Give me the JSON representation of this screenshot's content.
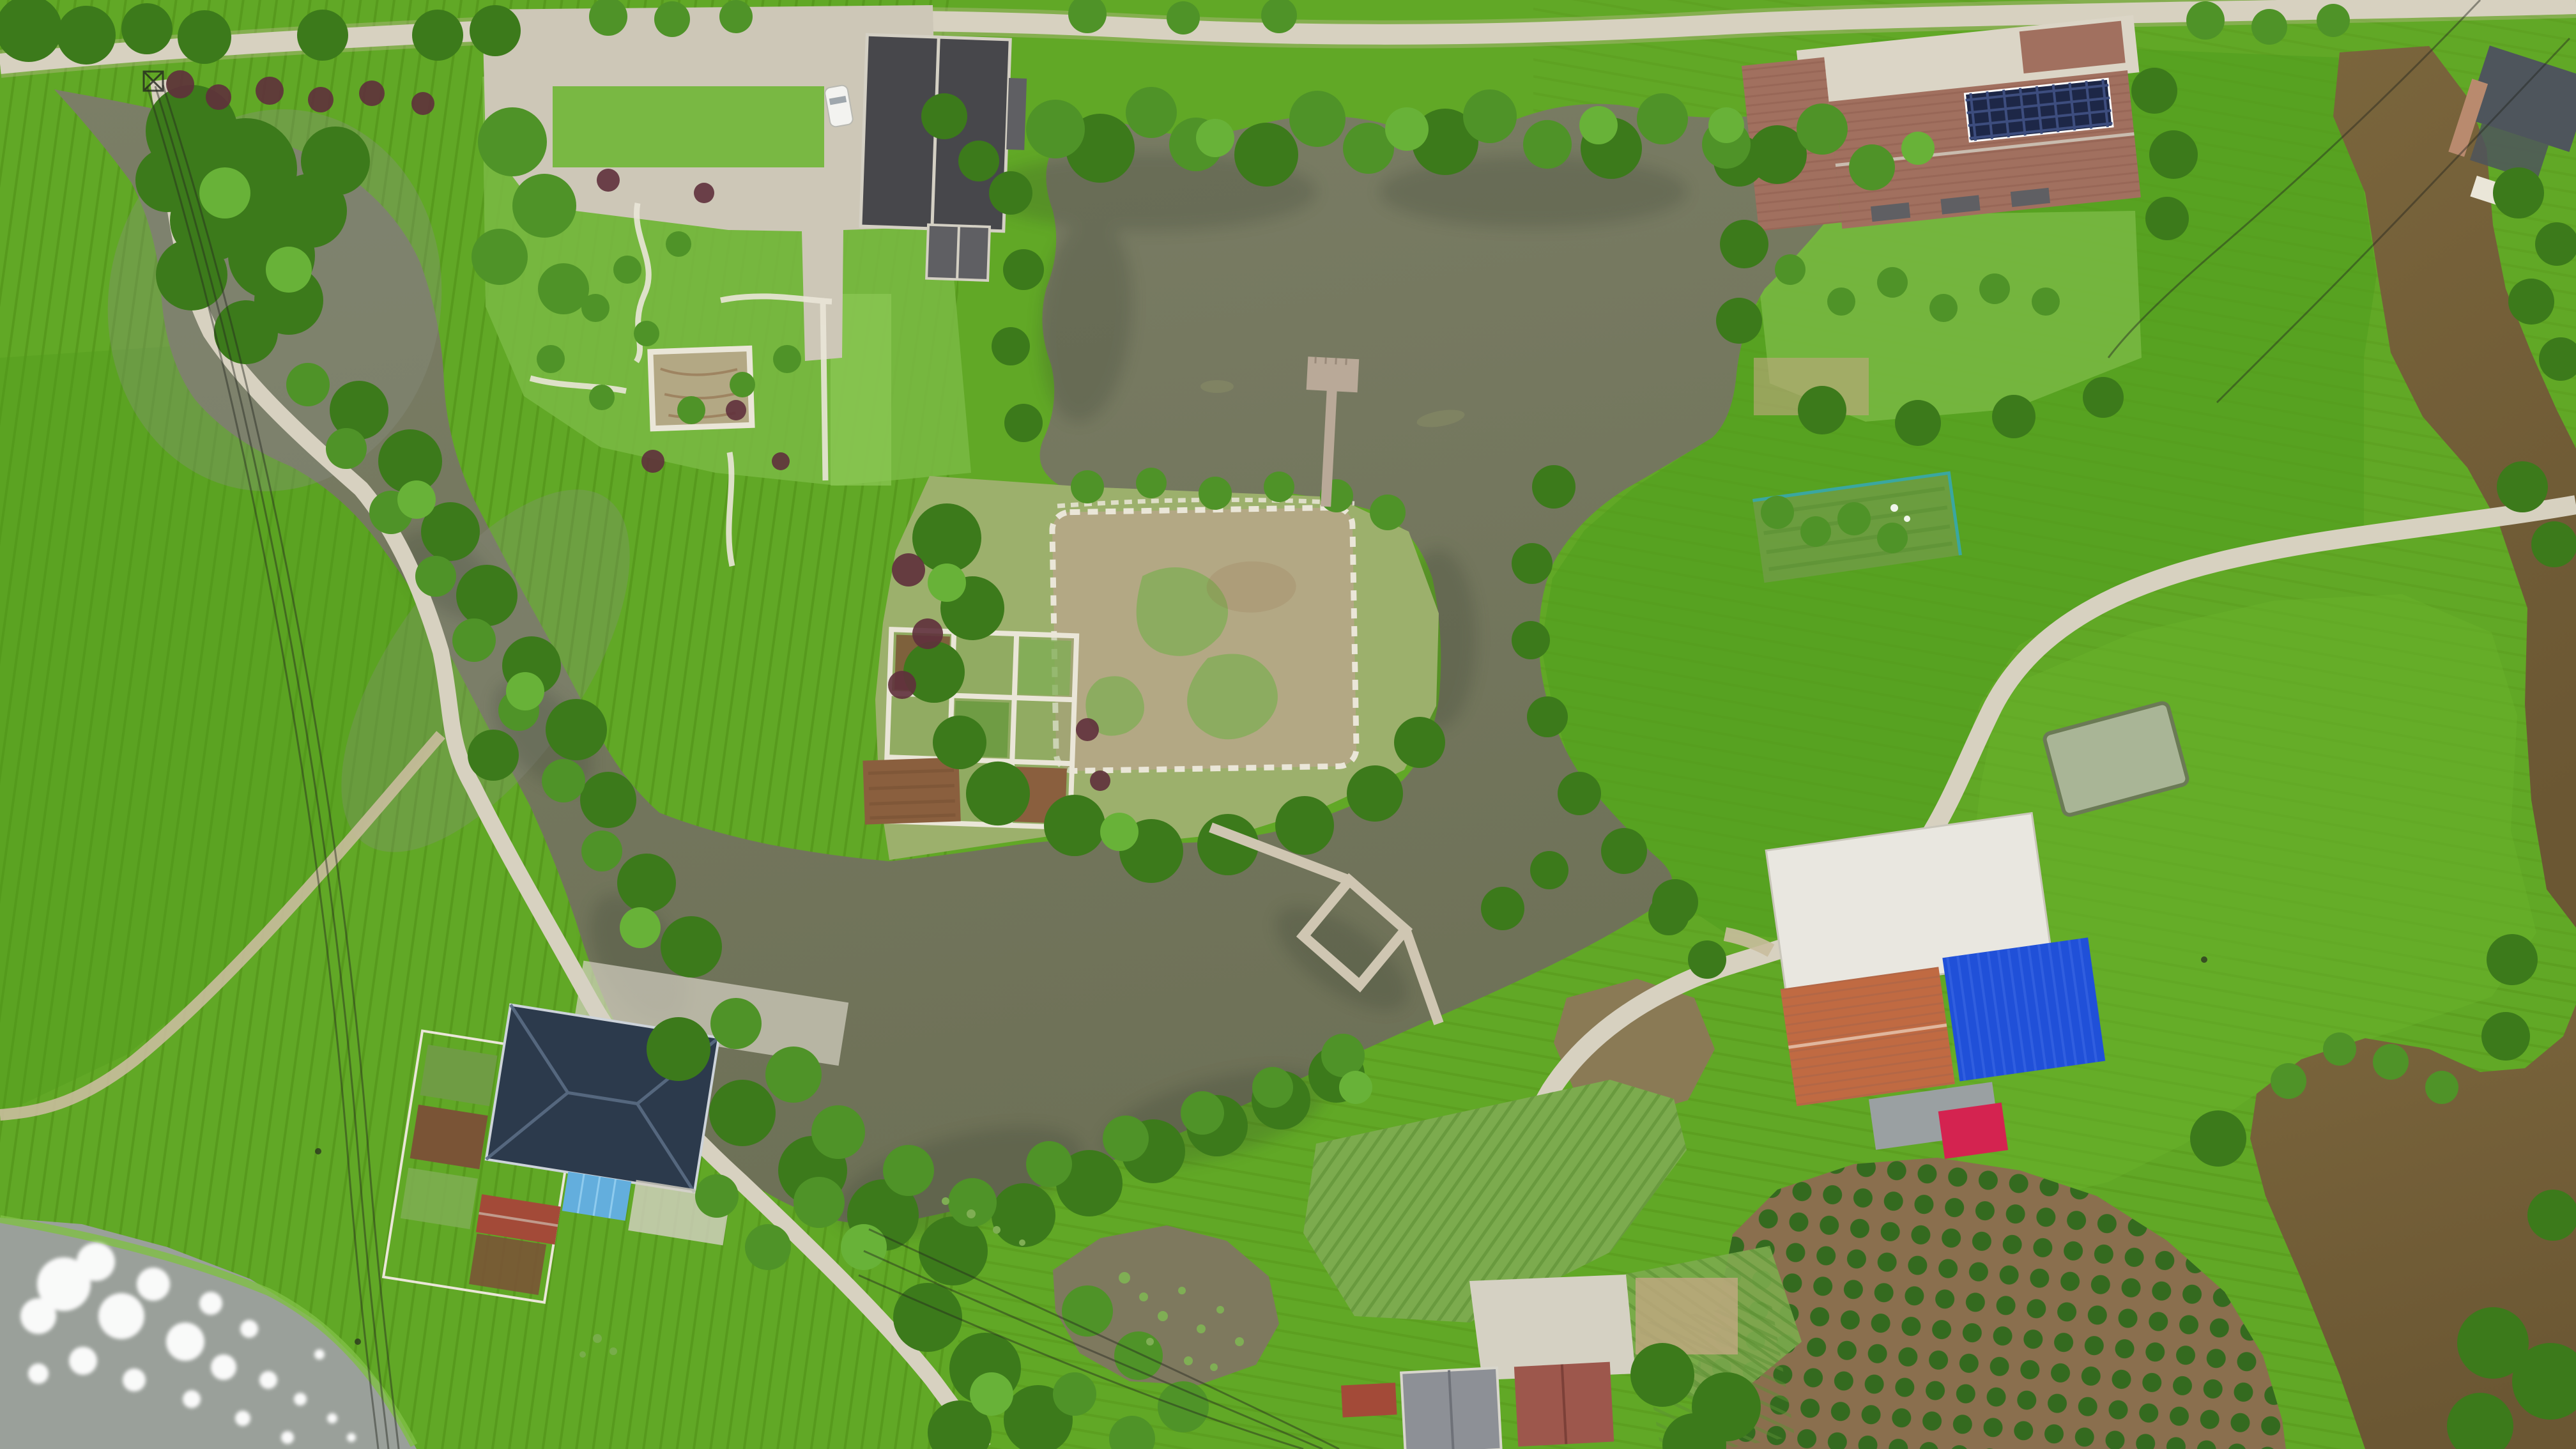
{
  "scene": {
    "type": "aerial-drone-photograph",
    "description": "Top-down drone view of a rural village: bright green rice paddies, a large olive-green pond with a wooden boardwalk and diamond viewing platform, an island garden plot with stone border, a winding stream, farm houses with charcoal, red-tiled (with solar panels), navy, bright-blue and orange roofs, orchards, fish ponds and country roads.",
    "features": [
      {
        "name": "central-pond",
        "label": "large olive-green pond"
      },
      {
        "name": "garden-stream",
        "label": "winding stream from northwest"
      },
      {
        "name": "island-plot",
        "label": "island garden plot with stone border"
      },
      {
        "name": "boardwalk",
        "label": "wooden boardwalk across pond"
      },
      {
        "name": "diamond-platform",
        "label": "diamond shaped viewing platform"
      },
      {
        "name": "t-dock",
        "label": "T-shaped wooden dock"
      },
      {
        "name": "estate-house",
        "label": "charcoal-roof estate house with garden"
      },
      {
        "name": "farmhouse-solar",
        "label": "red tiled farmhouse with solar panels"
      },
      {
        "name": "blue-warehouse",
        "label": "bright blue metal roof building"
      },
      {
        "name": "orange-roof-building",
        "label": "orange tiled farm building with red awning"
      },
      {
        "name": "navy-roof-house",
        "label": "navy hip-roof house with sky-blue annex"
      },
      {
        "name": "village-houses",
        "label": "village houses with gray and red roofs"
      },
      {
        "name": "rice-paddies",
        "label": "bright green rice paddies"
      },
      {
        "name": "orchard",
        "label": "orchard rows on brown soil"
      },
      {
        "name": "lotus-pond",
        "label": "small lotus pond"
      },
      {
        "name": "glint-pond",
        "label": "gray pond with sun glint"
      },
      {
        "name": "brown-ponds",
        "label": "muddy brown fish ponds"
      },
      {
        "name": "country-road",
        "label": "light concrete country roads"
      },
      {
        "name": "power-lines",
        "label": "overhead power lines"
      },
      {
        "name": "white-car",
        "label": "white parked car"
      }
    ]
  },
  "palette": {
    "riceBase": "#61a826",
    "riceRow": "#4e8c14",
    "riceDeep": "#509c1d",
    "riceBright": "#6ab42c",
    "meadow": "#79b843",
    "grassBank": "#7fbf45",
    "grassLight": "#8cc755",
    "islandGrass": "#9cb06c",
    "waterTop": "#7b7e66",
    "waterBottom": "#6e7157",
    "streamTint": "#8a8f81",
    "riverBrown": "#6b5733",
    "riverBrownLight": "#7a653c",
    "pondGray": "#9aa09a",
    "pondLotus": "#7e795e",
    "pondTan": "#8a7a55",
    "pondSage": "#a9b596",
    "algae": "#8a8f66",
    "shadowWater": "#2e392b",
    "roadLight": "#d7d1c0",
    "roadDirt": "#c9bd9d",
    "cobble": "#cdc7b7",
    "stoneWhite": "#eae6d8",
    "padConcrete": "#d5d1c3",
    "dirtPatch": "#c2a782",
    "treeDark": "#3c7a1b",
    "treeMid": "#4f9328",
    "treeLight": "#68b238",
    "shrubRed": "#5f303c",
    "orchardSoil": "#8a6f4e",
    "orchardTree": "#2f6a1c",
    "plotTan": "#b3a884",
    "weedGreen": "#7fae54",
    "gardenSoil": "#8a5f3e",
    "gardenSoilDark": "#7a5436",
    "cropGreen": "#6f9c44",
    "cropPatch": "#7cab4e",
    "cropRowLine": "#5c8f33",
    "fenceTeal": "#3aa7a0",
    "roofCharcoal": "#47474b",
    "roofRidge": "#d4d0c4",
    "roofAnnex": "#5f5f63",
    "farmRed": "#a1705f",
    "farmRedDark": "#8f5f50",
    "solarNavy": "#1d2747",
    "solarLine": "#3d4d7e",
    "courtyard": "#dbd5c6",
    "slateRight": "#4e555c",
    "wallBrick": "#b98a6e",
    "roofNavy": "#2c3a4c",
    "navyRidge": "#5a6d84",
    "eaveLight": "#cdd3da",
    "skyBlue": "#63aedd",
    "redSmall": "#a34a38",
    "blueBright": "#2050d8",
    "blueRib": "#4a74ea",
    "orangeRoof": "#c06a42",
    "crimson": "#d42350",
    "concreteGray": "#9aa0a2",
    "buildingWhite": "#e9e7e0",
    "villageGray": "#8d9096",
    "villageRed": "#9d574c",
    "boardwalk": "#cfc6b2",
    "dockTan": "#b9a998",
    "carWhite": "#f3f3f0",
    "powerLine": "#23261f",
    "glint": "#ffffff"
  }
}
